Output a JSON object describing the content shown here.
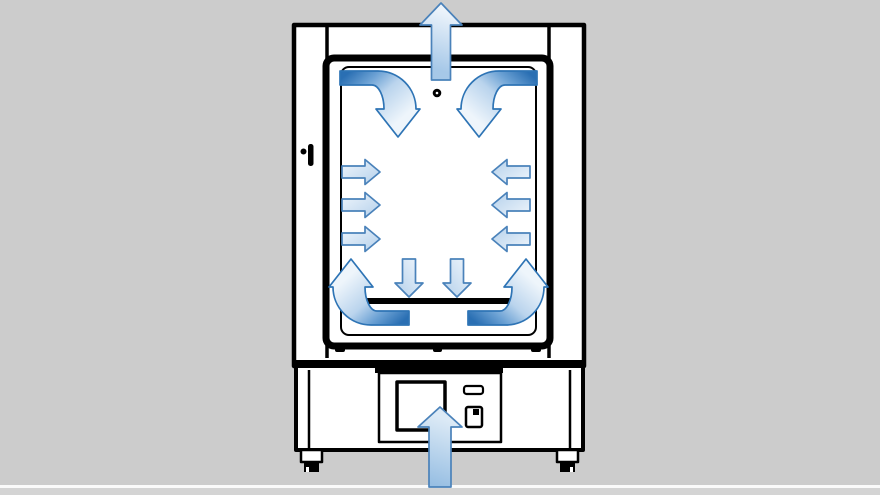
{
  "background": {
    "page": "#cccccc",
    "footer_line": "#fafafa",
    "footer_strip": "#d4d4d4"
  },
  "palette": {
    "line_art": "#000000",
    "cabinet_fill": "#ffffff",
    "arrow_outline": "#4a82ba",
    "bent_arrow_outline": "#2e74b5",
    "arrow_dark_blue": "#2a6fb3",
    "arrow_mid_blue": "#a6c8e8",
    "arrow_light_blue": "#eef4fb"
  },
  "diagram": {
    "subject": "laboratory oven / incubator front view with forced-air circulation arrows",
    "device_parts": [
      "cabinet-body",
      "door-frame",
      "chamber-window",
      "chamber-floor",
      "door-handle",
      "vent-hole",
      "base-unit",
      "control-panel",
      "display-screen",
      "power-slot",
      "power-switch",
      "left-foot",
      "right-foot"
    ],
    "airflow": {
      "inlet": "air enters upward through bottom center of base",
      "outlet": "air exits upward through top center of cabinet",
      "bent_arrows": [
        {
          "name": "top-left-bent-arrow",
          "flow": "along top wall curving downward",
          "transform": "translate(340,71)"
        },
        {
          "name": "top-right-bent-arrow",
          "flow": "along top wall curving downward",
          "transform": "translate(537,71) scale(-1,1)"
        },
        {
          "name": "bottom-left-bent-arrow",
          "flow": "along bottom curving up left wall",
          "transform": "translate(409,325) scale(-1,-1)"
        },
        {
          "name": "bottom-right-bent-arrow",
          "flow": "along bottom curving up right wall",
          "transform": "translate(468,325) scale(1,-1)"
        }
      ],
      "straight_arrows": [
        {
          "name": "outlet-arrow",
          "dir": "up",
          "x": 441,
          "y": 80,
          "len": 77,
          "shaft": 19,
          "head_w": 42,
          "head_l": 22,
          "fill": "outlet"
        },
        {
          "name": "inlet-arrow",
          "dir": "up",
          "x": 440,
          "y": 487,
          "len": 80,
          "shaft": 22,
          "head_w": 44,
          "head_l": 20,
          "fill": "inlet"
        },
        {
          "name": "left-wall-arrow-1",
          "dir": "right",
          "x": 342,
          "y": 172,
          "len": 38,
          "shaft": 12,
          "head_w": 25,
          "head_l": 15,
          "fill": "block"
        },
        {
          "name": "left-wall-arrow-2",
          "dir": "right",
          "x": 342,
          "y": 205,
          "len": 38,
          "shaft": 12,
          "head_w": 25,
          "head_l": 15,
          "fill": "block"
        },
        {
          "name": "left-wall-arrow-3",
          "dir": "right",
          "x": 342,
          "y": 239,
          "len": 38,
          "shaft": 12,
          "head_w": 25,
          "head_l": 15,
          "fill": "block"
        },
        {
          "name": "right-wall-arrow-1",
          "dir": "left",
          "x": 530,
          "y": 172,
          "len": 38,
          "shaft": 12,
          "head_w": 25,
          "head_l": 15,
          "fill": "block"
        },
        {
          "name": "right-wall-arrow-2",
          "dir": "left",
          "x": 530,
          "y": 205,
          "len": 38,
          "shaft": 12,
          "head_w": 25,
          "head_l": 15,
          "fill": "block"
        },
        {
          "name": "right-wall-arrow-3",
          "dir": "left",
          "x": 530,
          "y": 239,
          "len": 38,
          "shaft": 12,
          "head_w": 25,
          "head_l": 15,
          "fill": "block"
        },
        {
          "name": "center-down-arrow-1",
          "dir": "down",
          "x": 409,
          "y": 259,
          "len": 38,
          "shaft": 13,
          "head_w": 28,
          "head_l": 14,
          "fill": "block"
        },
        {
          "name": "center-down-arrow-2",
          "dir": "down",
          "x": 457,
          "y": 259,
          "len": 38,
          "shaft": 13,
          "head_w": 28,
          "head_l": 14,
          "fill": "block"
        }
      ]
    }
  }
}
